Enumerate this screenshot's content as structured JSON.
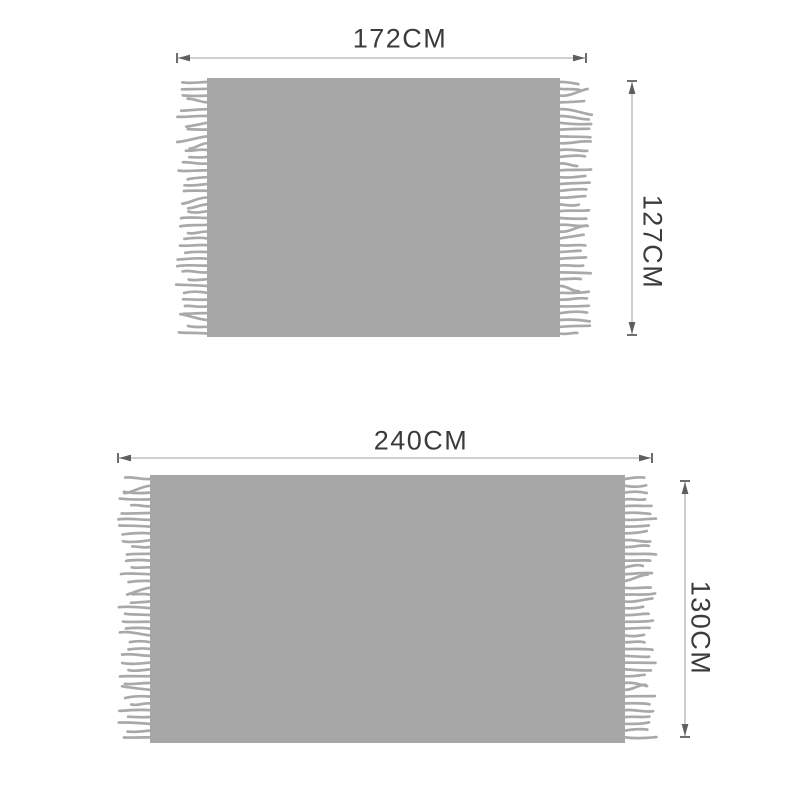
{
  "colors": {
    "background": "#ffffff",
    "blanket": "#a7a7a7",
    "fringe": "#a9a9a9",
    "dimension_line": "#b2b2b2",
    "arrowhead": "#5e5e5e",
    "label_text": "#3b3b3b"
  },
  "diagrams": [
    {
      "name": "small-blanket",
      "width_label": "172CM",
      "height_label": "127CM"
    },
    {
      "name": "large-blanket",
      "width_label": "240CM",
      "height_label": "130CM"
    }
  ]
}
